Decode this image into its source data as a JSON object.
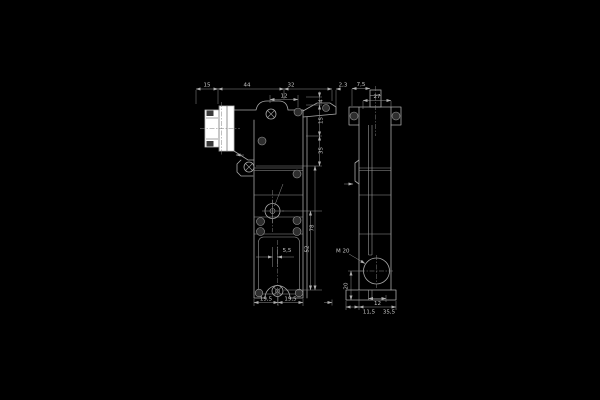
{
  "drawing": {
    "background": "#000000",
    "line_color": "#a8a8a8",
    "text_color": "#c6c6c6",
    "highlight_fill": "#ffffff",
    "front_view": {
      "dims_top": [
        "15",
        "44",
        "32",
        "2,3"
      ],
      "dim_screw_offset": "12",
      "dims_right_chain": [
        "4",
        "15",
        "35"
      ],
      "dims_right_outer": [
        "78",
        "52"
      ],
      "dim_center_offset": "5,5",
      "dims_bottom": [
        "19,5",
        "19,5"
      ]
    },
    "side_view": {
      "dim_top_offset": "7,5",
      "dim_width": "27",
      "gland_label": "M 20",
      "dim_gland_height": "20",
      "dim_slot": "12",
      "dims_bottom": [
        "11,5",
        "35,5"
      ]
    }
  }
}
